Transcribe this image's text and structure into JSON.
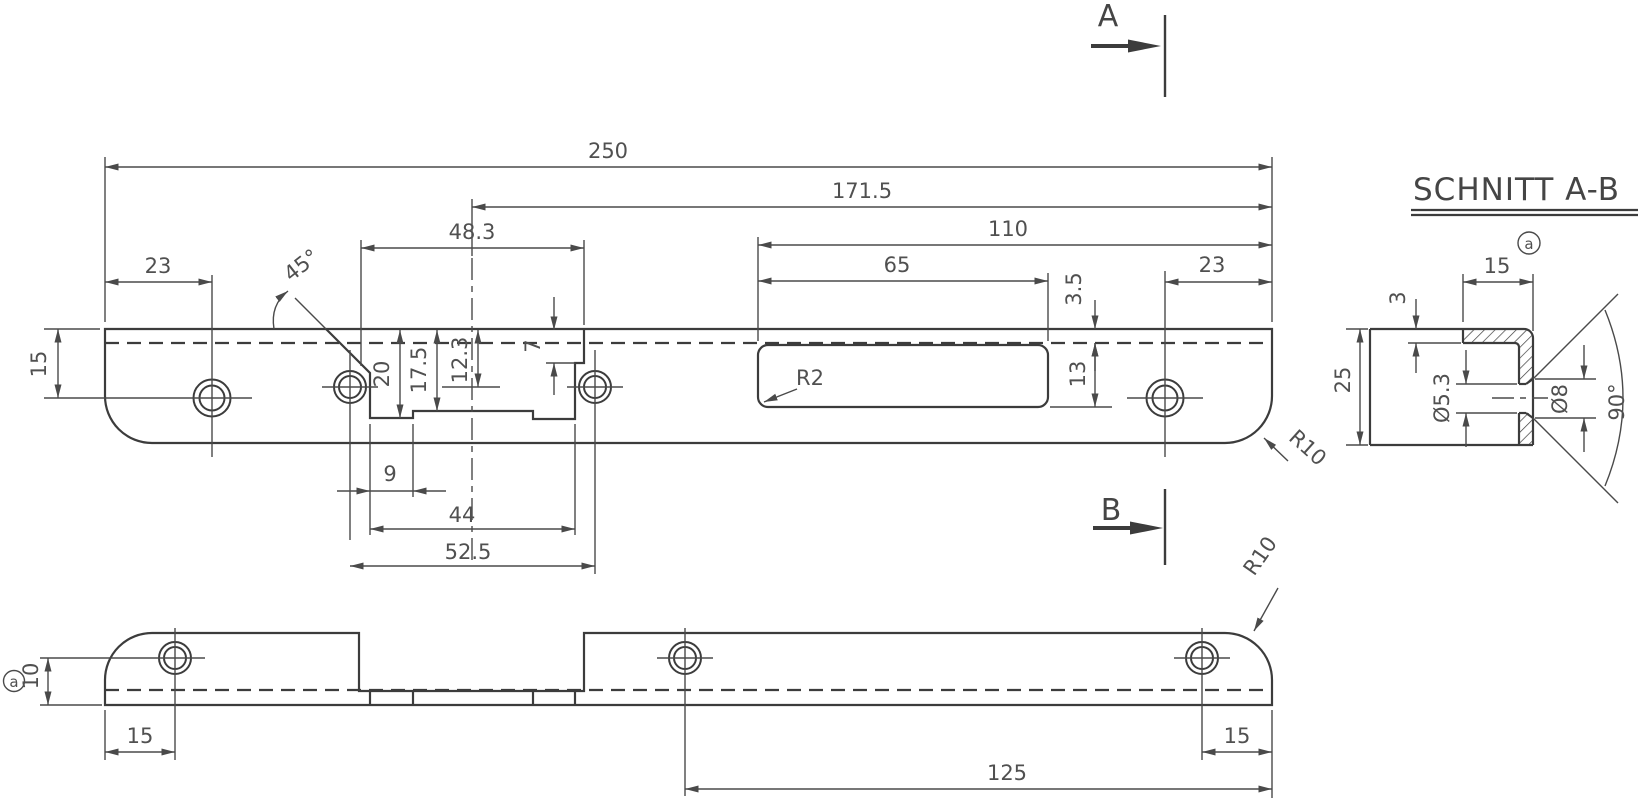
{
  "title": {
    "section": "SCHNITT A-B"
  },
  "section_markers": {
    "a": "A",
    "b": "B"
  },
  "datum": {
    "label": "a"
  },
  "colors": {
    "line": "#3c3c3c",
    "dim_line": "#4a4a4a",
    "text": "#505050",
    "background": "#ffffff"
  },
  "top_view": {
    "dims": {
      "total_length": "250",
      "center_to_end": "171.5",
      "slot_to_end": "110",
      "slot_length": "65",
      "left_hole_offset": "23",
      "right_hole_offset": "23",
      "faceplate_width": "48.3",
      "bevel_angle": "45°",
      "top_edge_to_hole": "15",
      "recess_depth_outer": "20",
      "recess_depth_mid": "17.5",
      "recess_depth_center": "12.3",
      "step_depth": "7",
      "lip_offset": "3.5",
      "slot_width": "13",
      "slot_corner_radius": "R2",
      "step_offset": "9",
      "recess_width_bottom": "44",
      "hole_spacing": "52.5",
      "corner_radius": "R10"
    }
  },
  "bottom_view": {
    "dims": {
      "hole_to_bottom": "10",
      "left_edge_to_hole": "15",
      "right_edge_to_hole": "15",
      "hole_to_end": "125",
      "corner_radius": "R10"
    }
  },
  "section_view": {
    "dims": {
      "lip_width": "15",
      "plate_thickness": "3",
      "plate_height": "25",
      "hole_diameter": "Ø5.3",
      "countersink_diameter": "Ø8",
      "countersink_angle": "90°"
    }
  }
}
